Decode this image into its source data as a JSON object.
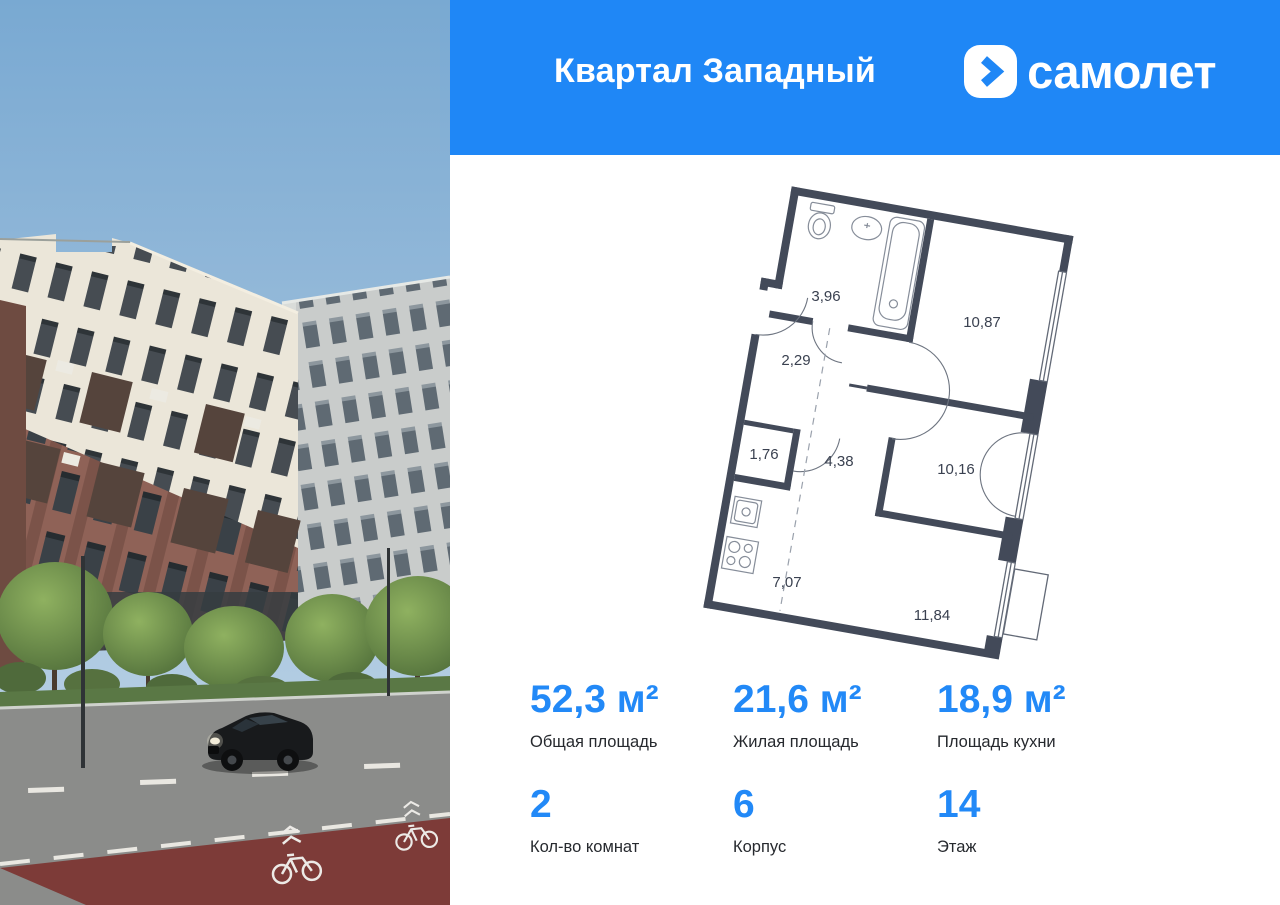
{
  "header": {
    "project_name": "Квартал Западный",
    "brand_name": "самолет"
  },
  "floor_plan": {
    "rooms": {
      "bathroom": "3,96",
      "hall": "2,29",
      "storage": "1,76",
      "corridor": "4,38",
      "kitchen": "7,07",
      "bedroom": "10,87",
      "room": "10,16",
      "living": "11,84"
    }
  },
  "stats": {
    "items": [
      {
        "value": "52,3 м²",
        "label": "Общая площадь"
      },
      {
        "value": "21,6 м²",
        "label": "Жилая площадь"
      },
      {
        "value": "18,9 м²",
        "label": "Площадь кухни"
      },
      {
        "value": "2",
        "label": "Кол-во комнат"
      },
      {
        "value": "6",
        "label": "Корпус"
      },
      {
        "value": "14",
        "label": "Этаж"
      }
    ]
  },
  "colors": {
    "header_blue": "#1f87f6",
    "stat_blue": "#2289f7",
    "plan_wall": "#434a59",
    "bike_lane_red": "#7d3b38"
  }
}
